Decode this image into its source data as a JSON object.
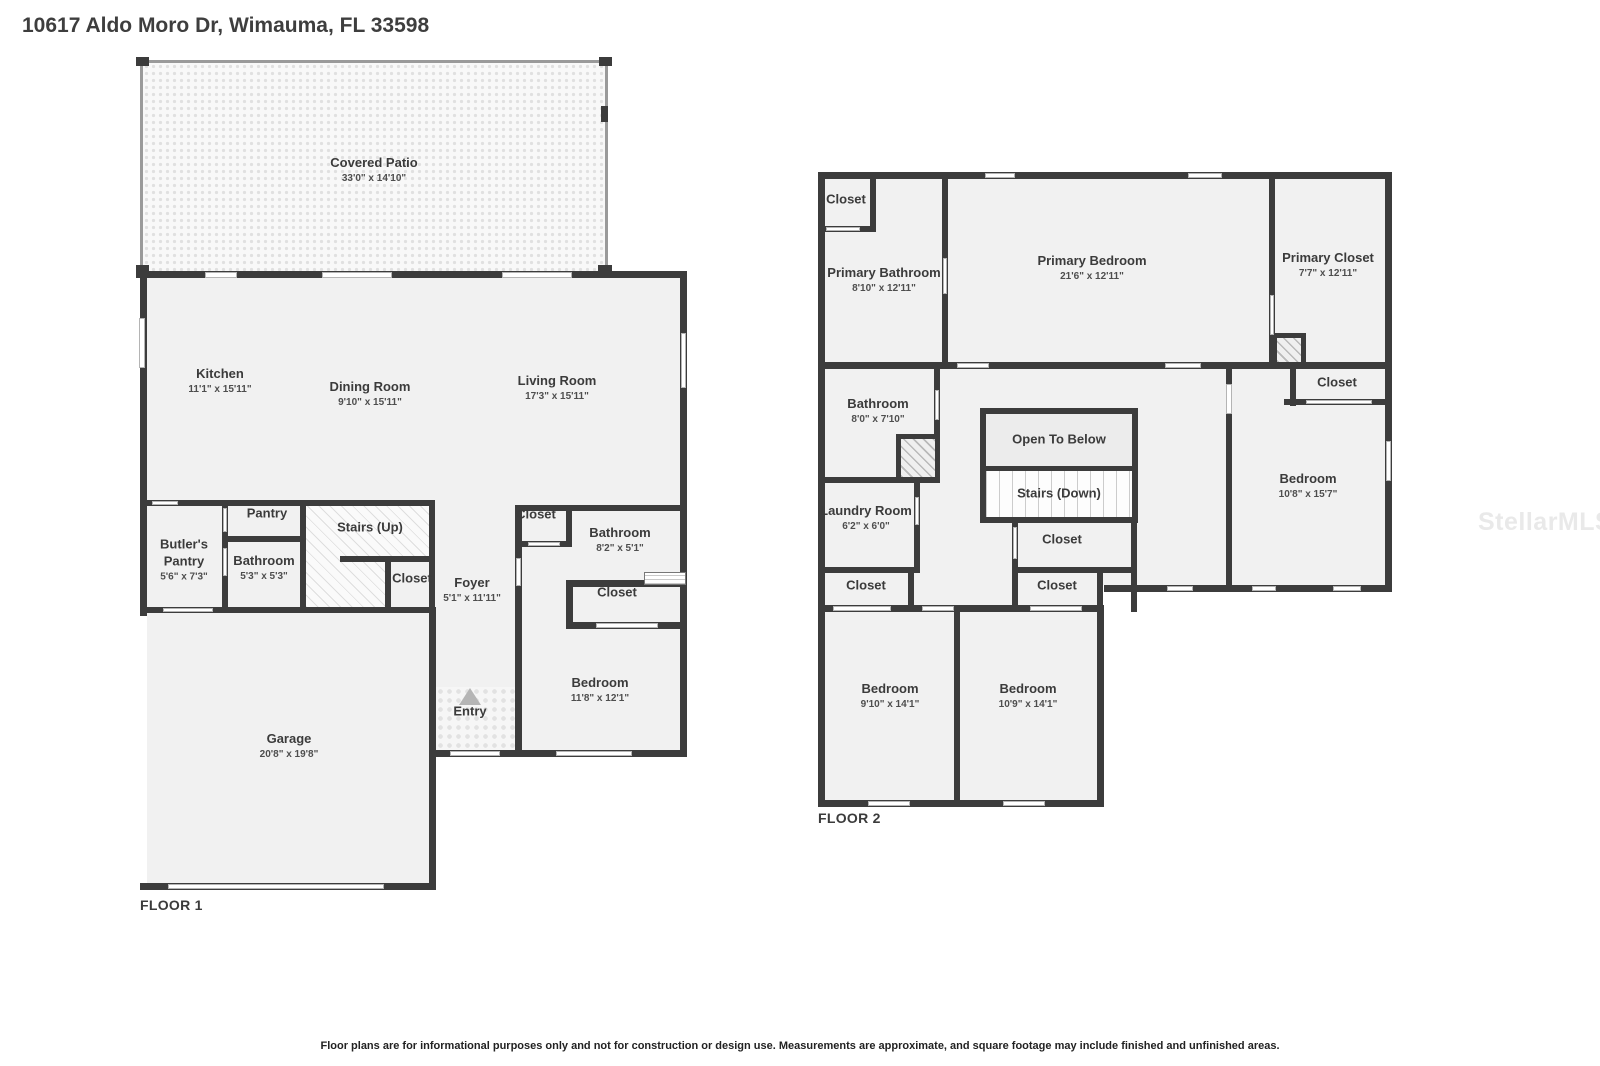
{
  "title": "10617 Aldo Moro Dr, Wimauma, FL 33598",
  "watermark": "StellarMLS",
  "disclaimer": "Floor plans are for informational purposes only and not for construction or design use. Measurements are approximate, and square footage may include finished and unfinished areas.",
  "floor1": {
    "label": "FLOOR 1",
    "rooms": {
      "covered_patio": {
        "name": "Covered Patio",
        "dims": "33'0\" x 14'10\""
      },
      "kitchen": {
        "name": "Kitchen",
        "dims": "11'1\" x 15'11\""
      },
      "dining_room": {
        "name": "Dining Room",
        "dims": "9'10\" x 15'11\""
      },
      "living_room": {
        "name": "Living Room",
        "dims": "17'3\" x 15'11\""
      },
      "butlers_pantry": {
        "name": "Butler's Pantry",
        "dims": "5'6\" x 7'3\""
      },
      "pantry": {
        "name": "Pantry"
      },
      "bathroom": {
        "name": "Bathroom",
        "dims": "5'3\" x 5'3\""
      },
      "stairs_up": {
        "name": "Stairs (Up)"
      },
      "stairs_closet": {
        "name": "Closet"
      },
      "foyer": {
        "name": "Foyer",
        "dims": "5'1\" x 11'11\""
      },
      "hall_closet": {
        "name": "Closet"
      },
      "bathroom2": {
        "name": "Bathroom",
        "dims": "8'2\" x 5'1\""
      },
      "bedroom_closet": {
        "name": "Closet"
      },
      "bedroom": {
        "name": "Bedroom",
        "dims": "11'8\" x 12'1\""
      },
      "entry": {
        "name": "Entry"
      },
      "garage": {
        "name": "Garage",
        "dims": "20'8\" x 19'8\""
      }
    }
  },
  "floor2": {
    "label": "FLOOR 2",
    "rooms": {
      "closet_a": {
        "name": "Closet"
      },
      "primary_bathroom": {
        "name": "Primary Bathroom",
        "dims": "8'10\" x 12'11\""
      },
      "primary_bedroom": {
        "name": "Primary Bedroom",
        "dims": "21'6\" x 12'11\""
      },
      "primary_closet": {
        "name": "Primary Closet",
        "dims": "7'7\" x 12'11\""
      },
      "bathroom": {
        "name": "Bathroom",
        "dims": "8'0\" x 7'10\""
      },
      "laundry_room": {
        "name": "Laundry Room",
        "dims": "6'2\" x 6'0\""
      },
      "open_to_below": {
        "name": "Open To Below"
      },
      "stairs_down": {
        "name": "Stairs (Down)"
      },
      "hall_closet": {
        "name": "Closet"
      },
      "hall_closet_2": {
        "name": "Closet"
      },
      "left_closet": {
        "name": "Closet"
      },
      "bedroom_closet": {
        "name": "Closet"
      },
      "bedroom_right": {
        "name": "Bedroom",
        "dims": "10'8\" x 15'7\""
      },
      "bedroom_a": {
        "name": "Bedroom",
        "dims": "9'10\" x 14'1\""
      },
      "bedroom_b": {
        "name": "Bedroom",
        "dims": "10'9\" x 14'1\""
      }
    }
  }
}
